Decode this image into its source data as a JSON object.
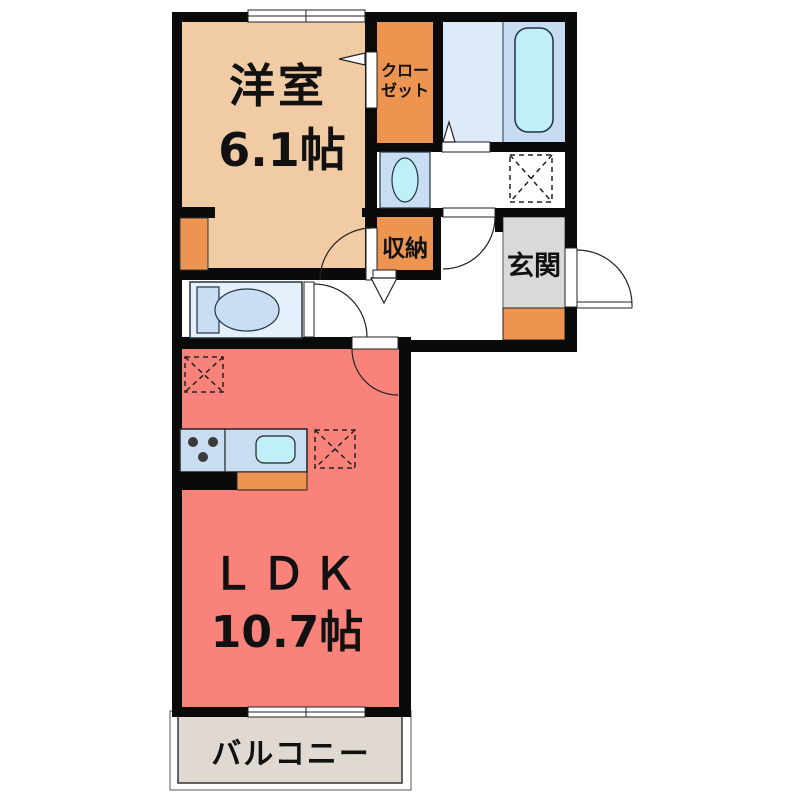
{
  "floorplan": {
    "title": "1LDK apartment floor plan",
    "labels": {
      "western_room_name": "洋室",
      "western_room_size": "6.1帖",
      "closet_line1": "クロー",
      "closet_line2": "ゼット",
      "storage": "収納",
      "entrance": "玄関",
      "ldk_name": "ＬＤＫ",
      "ldk_size": "10.7帖",
      "balcony": "バルコニー"
    },
    "colors": {
      "wall": "#0a0a0a",
      "western_room_floor": "#F1CBA4",
      "ldk_floor": "#F9837B",
      "orange_fixture": "#EE9451",
      "bath_floor": "#DCE9F7",
      "bath_inner_floor": "#C7DBF2",
      "bathtub": "#C1EFF7",
      "toilet_floor": "#E4F0FB",
      "fixture_blue": "#C9DDF5",
      "sink_cyan": "#BFF0FA",
      "entrance_floor": "#D9D9D9",
      "balcony_floor": "#DFD9D1",
      "kitchen_counter": "#C9DDF2",
      "outline": "#222222"
    }
  }
}
